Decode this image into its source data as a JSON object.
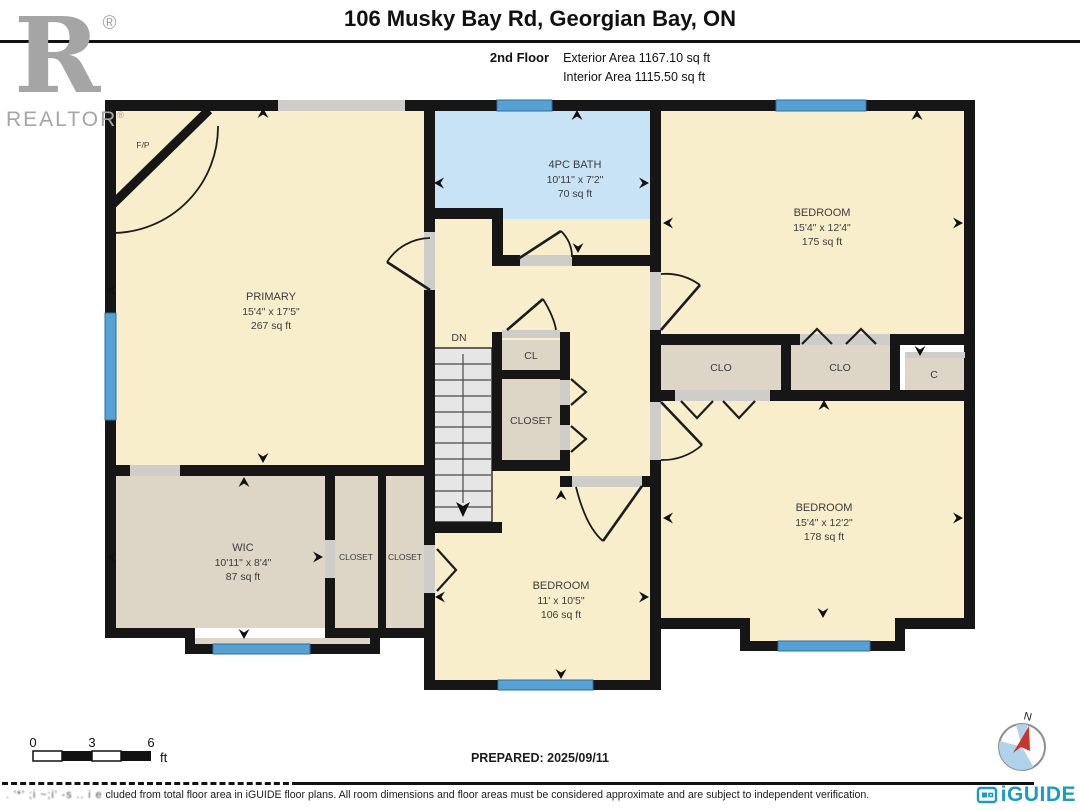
{
  "header": {
    "title": "106 Musky Bay Rd, Georgian Bay, ON",
    "floor_label": "2nd Floor",
    "exterior_area": "Exterior Area 1167.10 sq ft",
    "interior_area": "Interior Area 1115.50 sq ft"
  },
  "branding": {
    "realtor_r": "R",
    "realtor_word": "REALTOR",
    "reg_mark": "®",
    "iguide_logo": "iGUIDE"
  },
  "rooms": {
    "primary": {
      "name": "PRIMARY",
      "dims": "15'4\" x 17'5\"",
      "area": "267 sq ft"
    },
    "bath": {
      "name": "4PC BATH",
      "dims": "10'11\" x 7'2\"",
      "area": "70 sq ft"
    },
    "bedroom_top_right": {
      "name": "BEDROOM",
      "dims": "15'4\" x 12'4\"",
      "area": "175 sq ft"
    },
    "bedroom_bottom_right": {
      "name": "BEDROOM",
      "dims": "15'4\" x 12'2\"",
      "area": "178 sq ft"
    },
    "bedroom_bottom_center": {
      "name": "BEDROOM",
      "dims": "11' x 10'5\"",
      "area": "106 sq ft"
    },
    "wic": {
      "name": "WIC",
      "dims": "10'11\" x 8'4\"",
      "area": "87 sq ft"
    },
    "hall": {
      "name": "HALL"
    },
    "stairs": {
      "label": "DN"
    },
    "cl": {
      "label": "CL"
    },
    "closet_center": {
      "label": "CLOSET"
    },
    "closet_left_1": {
      "label": "CLOSET"
    },
    "closet_left_2": {
      "label": "CLOSET"
    },
    "clo_1": {
      "label": "CLO"
    },
    "clo_2": {
      "label": "CLO"
    },
    "c_closet": {
      "label": "C"
    },
    "fireplace": {
      "label": "F/P"
    }
  },
  "footer": {
    "scale": {
      "t0": "0",
      "t3": "3",
      "t6": "6",
      "unit": "ft"
    },
    "prepared": "PREPARED: 2025/09/11",
    "compass_n": "N",
    "disclaimer_prefix": ". '*' ;i ~;i' -s .. i e",
    "disclaimer_text": "cluded from total floor area in iGUIDE floor plans. All room dimensions and floor areas must be considered approximate and are subject to independent verification."
  },
  "colors": {
    "wall": "#161616",
    "cream": "#f8eecb",
    "tan": "#ddd5c6",
    "bath_blue": "#c8e3f5",
    "window_blue": "#55a0d4",
    "opening_gray": "#cfcdc9",
    "stair_gray": "#e6e6e6",
    "realtor_gray": "#a5a5a5",
    "iguide_teal": "#1d9bc4",
    "compass_red": "#c9342b",
    "compass_blue": "#aed3ea"
  }
}
